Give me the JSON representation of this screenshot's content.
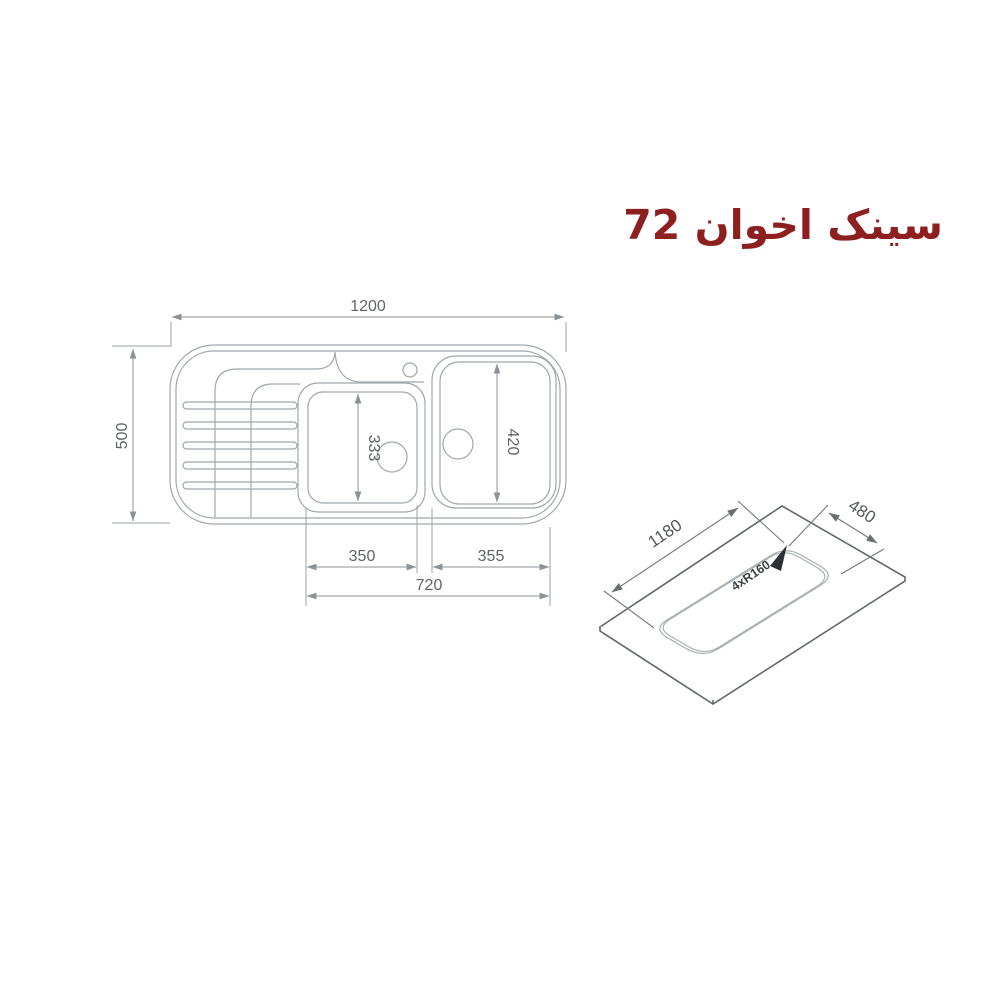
{
  "title": {
    "text": "سینک اخوان 72",
    "color": "#8e1f1f"
  },
  "top_view": {
    "overall_width": "1200",
    "overall_depth": "500",
    "bowl1_inner_length": "333",
    "bowl2_inner_length": "420",
    "bowl1_width": "350",
    "bowl2_width": "355",
    "bowls_span": "720"
  },
  "cutout_view": {
    "length": "1180",
    "depth": "480",
    "corner_radius": "4xR160"
  },
  "colors": {
    "title": "#8e1f1f",
    "drawing_line": "#a0a6aa",
    "dimension_text": "#606468",
    "iso_sheet_line": "#63686c",
    "arrow": "#2e3236"
  }
}
